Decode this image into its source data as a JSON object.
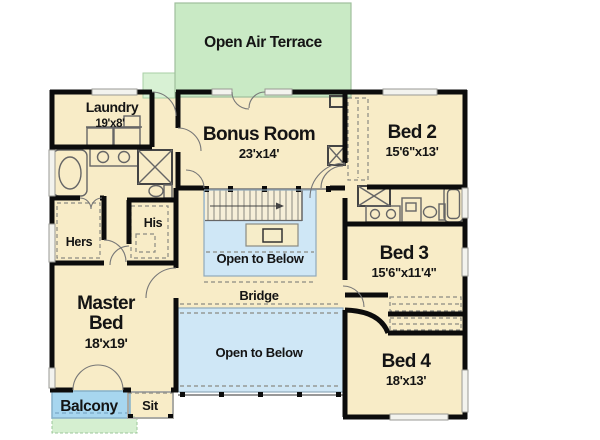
{
  "plan_title": "Second Floor Plan",
  "rooms": {
    "terrace": {
      "name": "Open Air Terrace"
    },
    "laundry": {
      "name": "Laundry",
      "dims": "19'x8'"
    },
    "bonus": {
      "name": "Bonus Room",
      "dims": "23'x14'"
    },
    "bed2": {
      "name": "Bed 2",
      "dims": "15'6\"x13'"
    },
    "bed3": {
      "name": "Bed 3",
      "dims": "15'6\"x11'4\""
    },
    "bed4": {
      "name": "Bed 4",
      "dims": "18'x13'"
    },
    "master": {
      "name_line1": "Master",
      "name_line2": "Bed",
      "dims": "18'x19'"
    },
    "hers": {
      "name": "Hers"
    },
    "his": {
      "name": "His"
    },
    "open_upper": {
      "name": "Open to Below"
    },
    "open_lower": {
      "name": "Open to Below"
    },
    "bridge": {
      "name": "Bridge"
    },
    "balcony": {
      "name": "Balcony"
    },
    "sit": {
      "name": "Sit"
    }
  },
  "colors": {
    "floor": "#f8ecc7",
    "terrace_green": "#c9eac5",
    "porch_green": "#d5efd0",
    "open_below_blue": "#cfe7f6",
    "balcony_blue": "#a7d6ef",
    "wall_black": "#0c0c0c",
    "text": "#141414"
  }
}
